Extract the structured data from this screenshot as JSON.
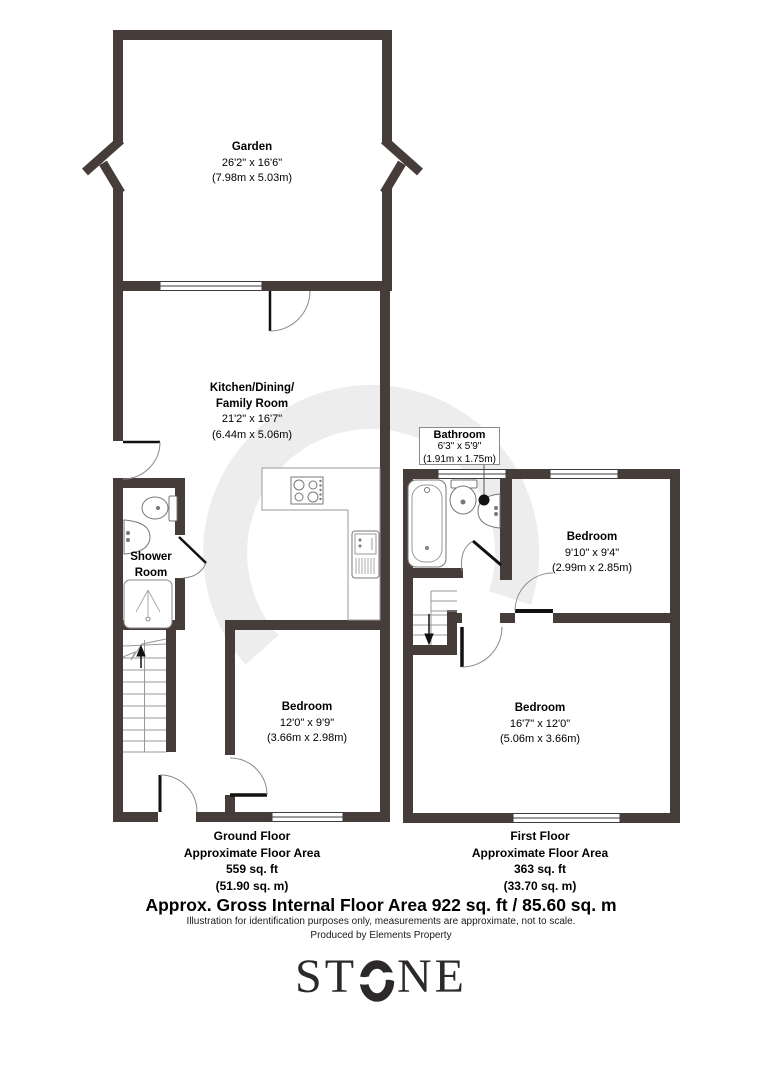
{
  "plan": {
    "garden": {
      "name": "Garden",
      "imperial": "26'2\" x 16'6\"",
      "metric": "(7.98m x 5.03m)"
    },
    "kitchen": {
      "name_line1": "Kitchen/Dining/",
      "name_line2": "Family Room",
      "imperial": "21'2\" x 16'7\"",
      "metric": "(6.44m x 5.06m)"
    },
    "shower_room": {
      "name_line1": "Shower",
      "name_line2": "Room"
    },
    "bedroom_ground": {
      "name": "Bedroom",
      "imperial": "12'0\" x 9'9\"",
      "metric": "(3.66m x 2.98m)"
    },
    "bathroom": {
      "name": "Bathroom",
      "imperial": "6'3\" x 5'9\"",
      "metric": "(1.91m x 1.75m)"
    },
    "bedroom_first_small": {
      "name": "Bedroom",
      "imperial": "9'10\" x 9'4\"",
      "metric": "(2.99m x 2.85m)"
    },
    "bedroom_first_large": {
      "name": "Bedroom",
      "imperial": "16'7\" x 12'0\"",
      "metric": "(5.06m x 3.66m)"
    }
  },
  "floors": {
    "ground": {
      "label": "Ground Floor",
      "sub": "Approximate Floor Area",
      "area_ft": "559 sq. ft",
      "area_m": "(51.90 sq. m)"
    },
    "first": {
      "label": "First Floor",
      "sub": "Approximate Floor Area",
      "area_ft": "363 sq. ft",
      "area_m": "(33.70 sq. m)"
    }
  },
  "footer": {
    "gross_area": "Approx. Gross Internal Floor Area 922 sq. ft / 85.60 sq. m",
    "disclaimer": "Illustration for identification purposes only, measurements are approximate, not to scale.",
    "credit": "Produced by Elements Property"
  },
  "branding": {
    "logo_left": "ST",
    "logo_right": "NE"
  },
  "colors": {
    "wall": "#463c3a",
    "door_leaf": "#111111",
    "door_arc": "#8a8a8a",
    "fixture": "#777777",
    "watermark": "#ededed"
  }
}
